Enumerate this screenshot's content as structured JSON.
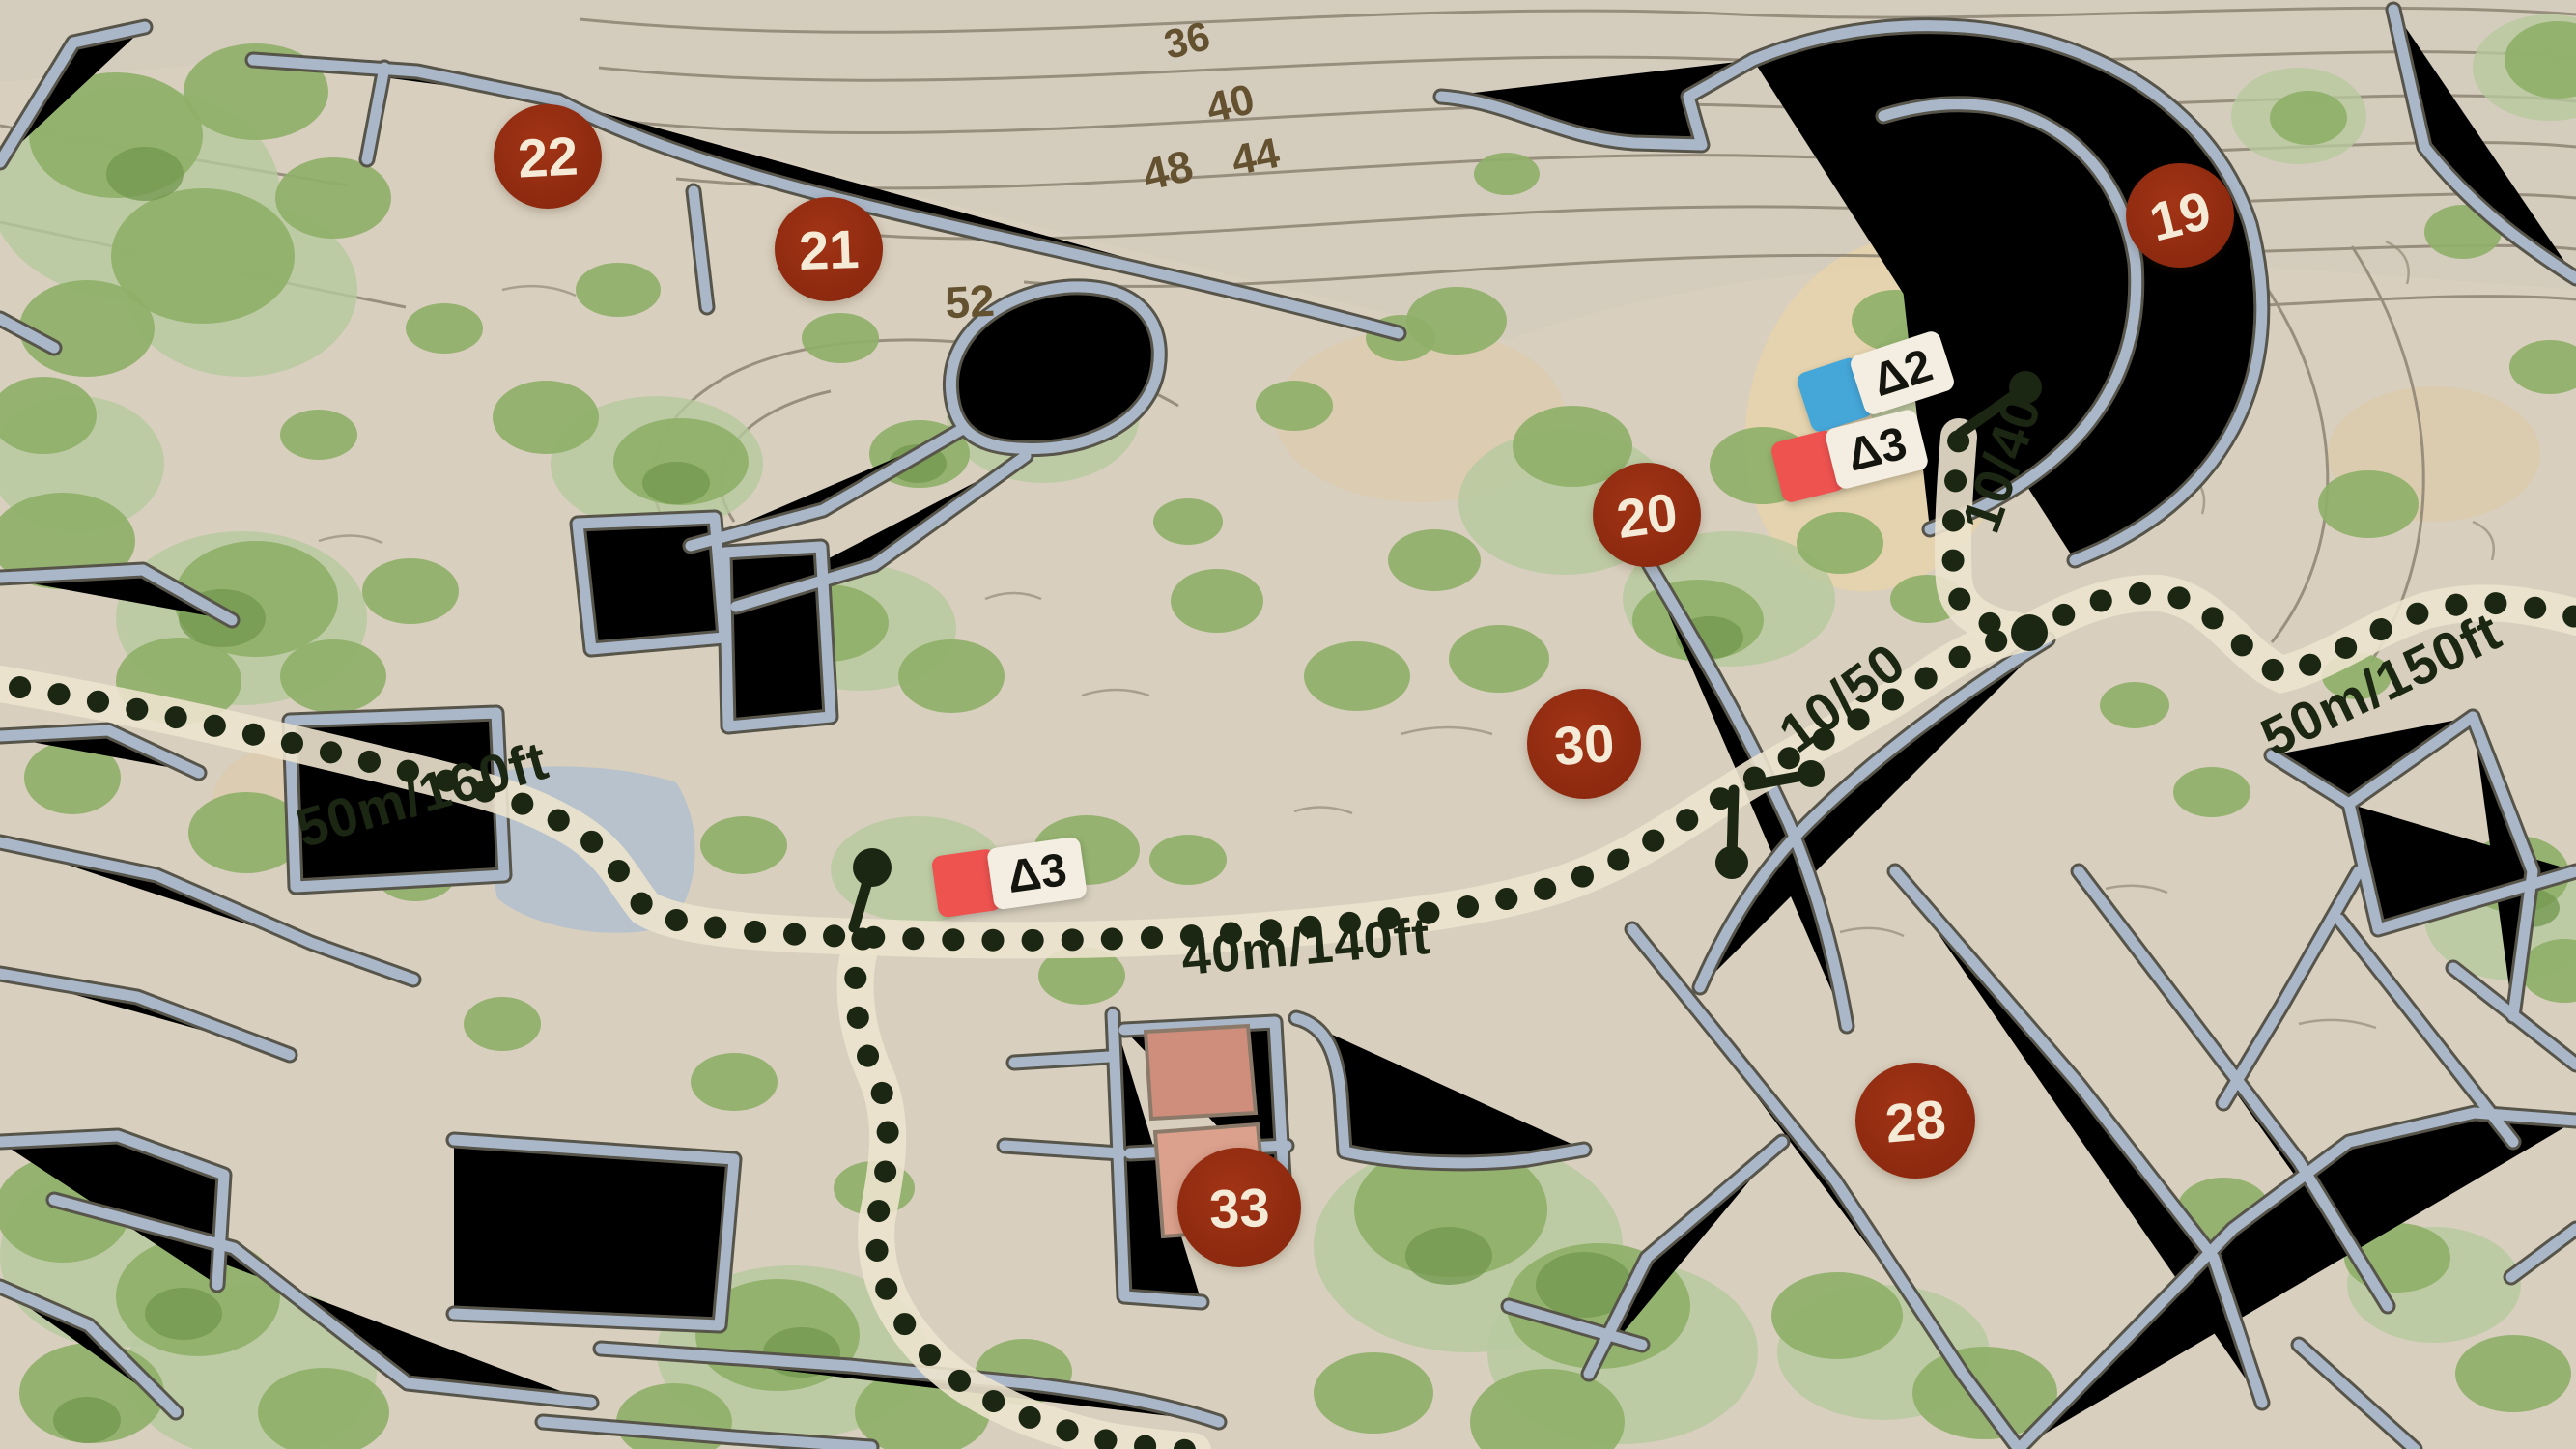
{
  "map": {
    "markers": [
      {
        "number": "22"
      },
      {
        "number": "21"
      },
      {
        "number": "20"
      },
      {
        "number": "19"
      },
      {
        "number": "30"
      },
      {
        "number": "28"
      },
      {
        "number": "33"
      }
    ],
    "contours": [
      {
        "elevation": "36"
      },
      {
        "elevation": "40"
      },
      {
        "elevation": "44"
      },
      {
        "elevation": "48"
      },
      {
        "elevation": "52"
      }
    ],
    "trail_labels": [
      {
        "text": "50m/160ft"
      },
      {
        "text": "40m/140ft"
      },
      {
        "text": "10/50"
      },
      {
        "text": "10/40"
      },
      {
        "text": "50m/150ft"
      }
    ],
    "flags": [
      {
        "label": "Δ2",
        "color": "#45a6d8"
      },
      {
        "label": "Δ3",
        "color": "#ee5350"
      },
      {
        "label": "Δ3",
        "color": "#ee5350"
      }
    ],
    "palette": {
      "parchment": "#d8cfbe",
      "vegetation": "#8fb069",
      "walls": "#a7b5c6",
      "marker_red": "#8e2a10",
      "trail_ink": "#1b2712",
      "flag_blue": "#45a6d8",
      "flag_red": "#ee5350",
      "building_pink": "#cf8d7c"
    }
  }
}
